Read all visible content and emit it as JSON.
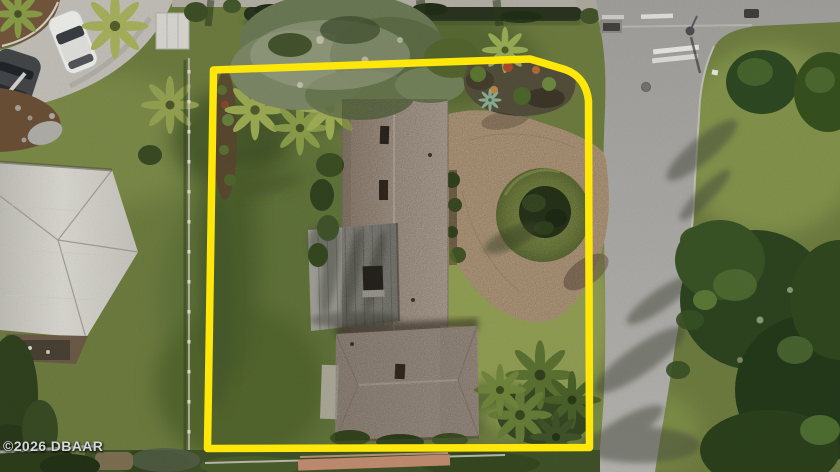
{
  "meta": {
    "type": "aerial-drone-photograph",
    "subject": "single-family home lot with highlighted property boundary"
  },
  "watermark": {
    "text": "©2026 DBAAR"
  },
  "boundary": {
    "color": "#ffe70a",
    "shape": "rectangle with angled top-right corner"
  },
  "palette": {
    "lawn": "#6f7e41",
    "lawn_light": "#93a055",
    "lawn_dark": "#4c5e2e",
    "road": "#a9a8a4",
    "sidewalk": "#b8b3a9",
    "pavers": "#c6ab8a",
    "shingle_roof": "#b0a093",
    "rear_roof": "#a89a8d",
    "metal_roof": "#95948c",
    "neighbor_roof": "#d6d4cd",
    "tree_dark": "#2e4521",
    "palm": "#9fae55",
    "mulch": "#5d4731"
  },
  "scene": {
    "elements": [
      "subject house",
      "paver driveway",
      "landscaped circular island",
      "street with crosswalk bar",
      "grass median",
      "large oak canopy",
      "palm trees",
      "neighbor house roof",
      "parked white car",
      "dark SUV",
      "yellow property-line overlay"
    ]
  }
}
